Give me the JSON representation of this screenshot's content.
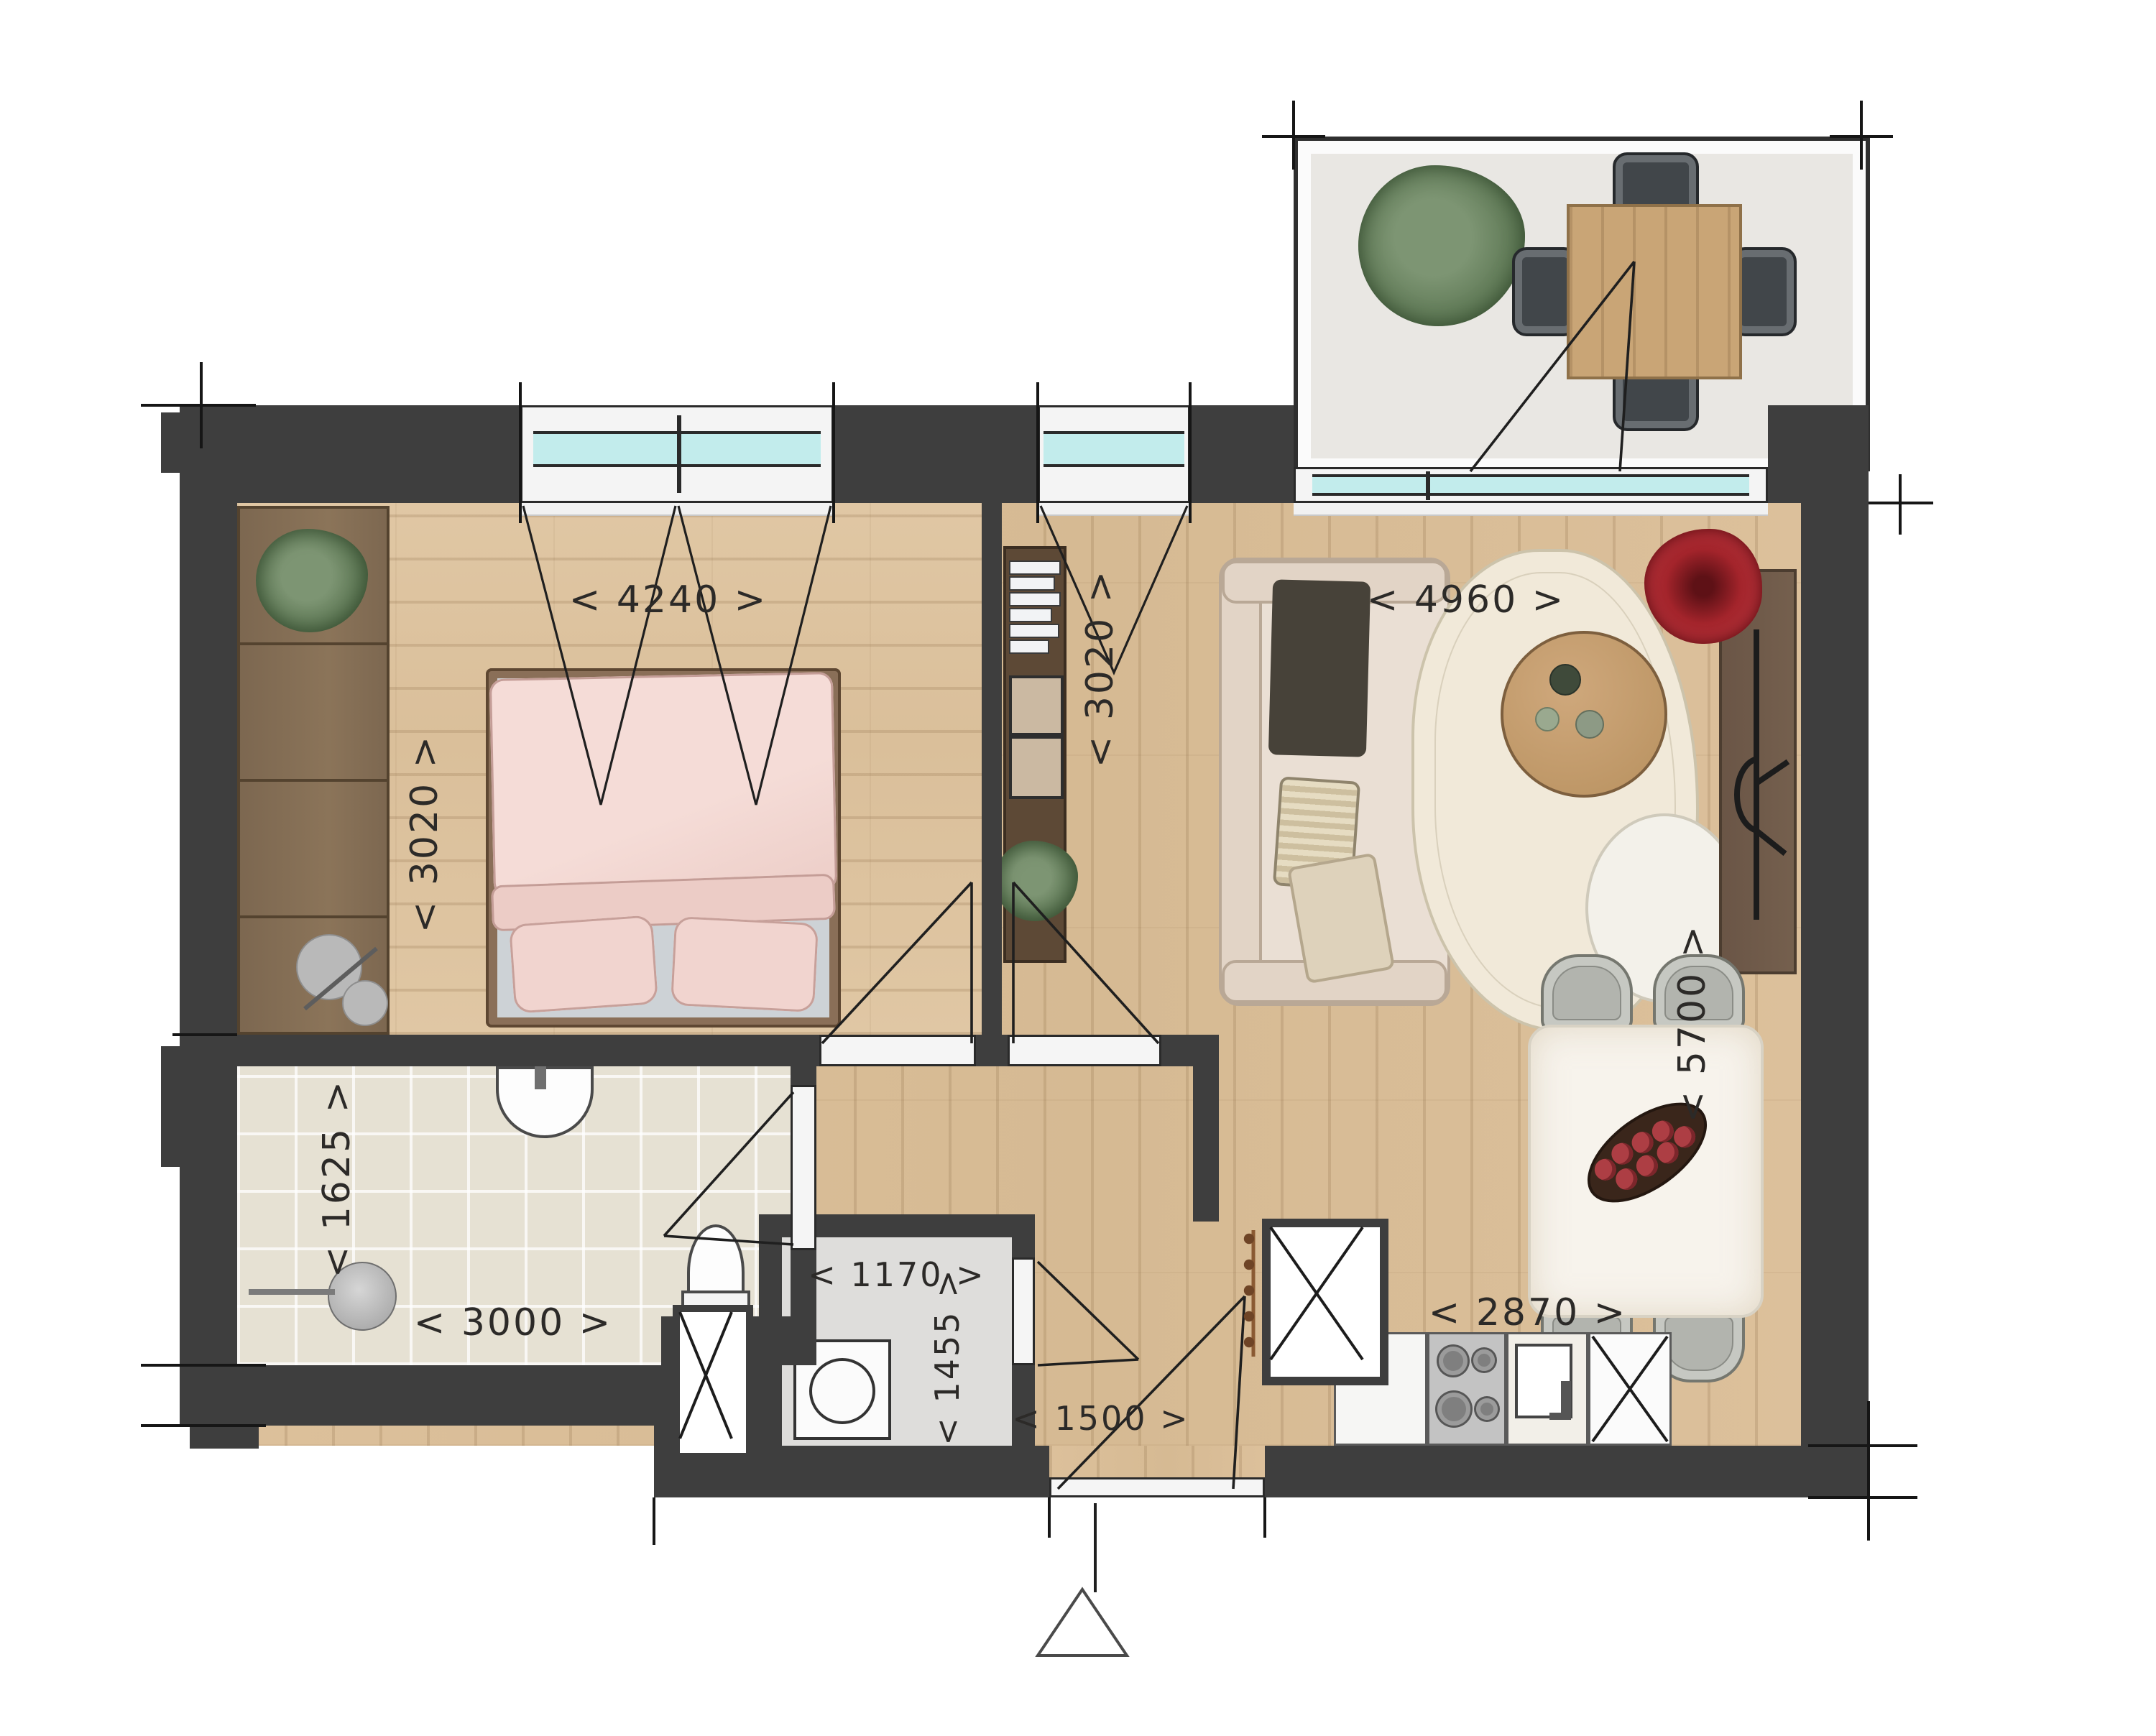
{
  "dimensions": {
    "bedroom_width": "< 4240 >",
    "bedroom_depth": "< 3020 >",
    "flex_depth": "< 3020 >",
    "living_width": "< 4960 >",
    "living_depth": "< 5700 >",
    "bathroom_depth": "< 1625 >",
    "bathroom_width": "< 3000 >",
    "storage_width": "< 1170 >",
    "storage_depth": "< 1455 >",
    "entrance_width": "< 1500 >",
    "kitchen_width": "< 2870 >"
  },
  "icons": {
    "entrance_marker": "triangle-up",
    "shaft_symbol": "diagonal-cross",
    "tall_unit_symbol": "diagonal-cross"
  },
  "colors": {
    "wall": "#3e3e3e",
    "wood_floor": "#d9be99",
    "bedroom_floor": "#dfc6a3",
    "bathroom_tile": "#e6e1d3",
    "storage_floor": "#dedddb",
    "balcony_floor": "#e9e7e3",
    "window_glass": "#c2ecec",
    "bed_pink": "#f3dad5",
    "sofa_beige": "#eadfd4",
    "accent_plant_red": "#a3242b",
    "plant_green": "#6d8a66",
    "dimension_text": "#2c2a28"
  }
}
